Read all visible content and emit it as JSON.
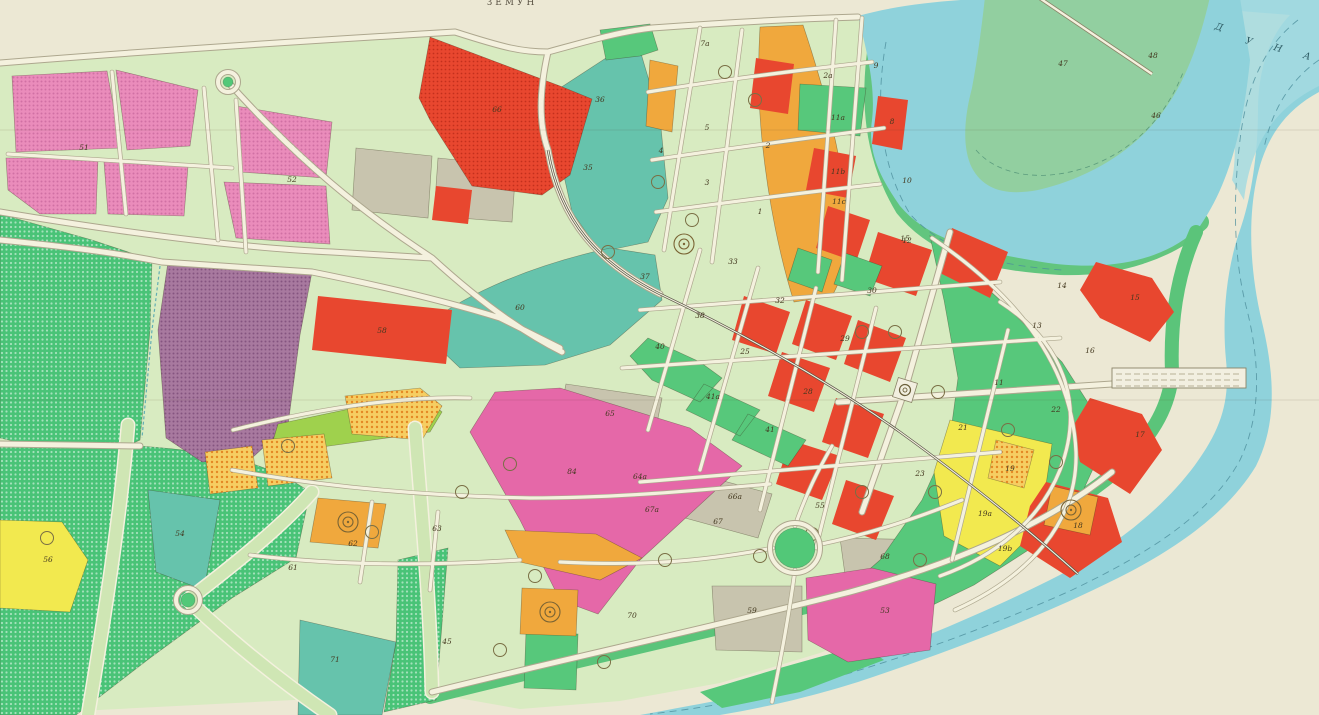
{
  "map": {
    "title": "ЗЕМУН",
    "river_letters": [
      {
        "ch": "Д",
        "x": 1218,
        "y": 30
      },
      {
        "ch": "У",
        "x": 1248,
        "y": 44
      },
      {
        "ch": "Н",
        "x": 1277,
        "y": 51
      },
      {
        "ch": "А",
        "x": 1306,
        "y": 59
      }
    ],
    "labels": [
      {
        "t": "51",
        "x": 84,
        "y": 150
      },
      {
        "t": "52",
        "x": 292,
        "y": 182
      },
      {
        "t": "66",
        "x": 497,
        "y": 112
      },
      {
        "t": "36",
        "x": 600,
        "y": 102
      },
      {
        "t": "35",
        "x": 588,
        "y": 170
      },
      {
        "t": "7a",
        "x": 705,
        "y": 46
      },
      {
        "t": "2a",
        "x": 828,
        "y": 78
      },
      {
        "t": "9",
        "x": 876,
        "y": 68
      },
      {
        "t": "8",
        "x": 892,
        "y": 124
      },
      {
        "t": "5",
        "x": 707,
        "y": 130
      },
      {
        "t": "4",
        "x": 661,
        "y": 153
      },
      {
        "t": "3",
        "x": 707,
        "y": 185
      },
      {
        "t": "2",
        "x": 768,
        "y": 148
      },
      {
        "t": "1",
        "x": 760,
        "y": 214
      },
      {
        "t": "11a",
        "x": 838,
        "y": 120
      },
      {
        "t": "11b",
        "x": 838,
        "y": 174
      },
      {
        "t": "11c",
        "x": 839,
        "y": 204
      },
      {
        "t": "10",
        "x": 907,
        "y": 183
      },
      {
        "t": "12",
        "x": 907,
        "y": 243
      },
      {
        "t": "15",
        "x": 905,
        "y": 241
      },
      {
        "t": "47",
        "x": 1063,
        "y": 66
      },
      {
        "t": "48",
        "x": 1153,
        "y": 58
      },
      {
        "t": "46",
        "x": 1156,
        "y": 118
      },
      {
        "t": "14",
        "x": 1062,
        "y": 288
      },
      {
        "t": "13",
        "x": 1037,
        "y": 328
      },
      {
        "t": "15",
        "x": 1135,
        "y": 300
      },
      {
        "t": "16",
        "x": 1090,
        "y": 353
      },
      {
        "t": "17",
        "x": 1140,
        "y": 437
      },
      {
        "t": "18",
        "x": 1078,
        "y": 528
      },
      {
        "t": "22",
        "x": 1056,
        "y": 412
      },
      {
        "t": "30",
        "x": 872,
        "y": 293
      },
      {
        "t": "29",
        "x": 845,
        "y": 341
      },
      {
        "t": "28",
        "x": 808,
        "y": 394
      },
      {
        "t": "33",
        "x": 733,
        "y": 264
      },
      {
        "t": "37",
        "x": 645,
        "y": 279
      },
      {
        "t": "38",
        "x": 700,
        "y": 318
      },
      {
        "t": "32",
        "x": 780,
        "y": 303
      },
      {
        "t": "25",
        "x": 745,
        "y": 354
      },
      {
        "t": "40",
        "x": 660,
        "y": 349
      },
      {
        "t": "41a",
        "x": 713,
        "y": 399
      },
      {
        "t": "41",
        "x": 770,
        "y": 432
      },
      {
        "t": "65",
        "x": 610,
        "y": 416
      },
      {
        "t": "64a",
        "x": 640,
        "y": 479
      },
      {
        "t": "66a",
        "x": 735,
        "y": 499
      },
      {
        "t": "68",
        "x": 885,
        "y": 559
      },
      {
        "t": "23",
        "x": 920,
        "y": 476
      },
      {
        "t": "21",
        "x": 963,
        "y": 430
      },
      {
        "t": "11",
        "x": 999,
        "y": 385
      },
      {
        "t": "19",
        "x": 1010,
        "y": 471
      },
      {
        "t": "19a",
        "x": 985,
        "y": 516
      },
      {
        "t": "19b",
        "x": 1005,
        "y": 551
      },
      {
        "t": "55",
        "x": 820,
        "y": 508
      },
      {
        "t": "60",
        "x": 520,
        "y": 310
      },
      {
        "t": "84",
        "x": 572,
        "y": 474
      },
      {
        "t": "58",
        "x": 382,
        "y": 333
      },
      {
        "t": "61",
        "x": 293,
        "y": 570
      },
      {
        "t": "62",
        "x": 353,
        "y": 546
      },
      {
        "t": "63",
        "x": 437,
        "y": 531
      },
      {
        "t": "67a",
        "x": 652,
        "y": 512
      },
      {
        "t": "67",
        "x": 718,
        "y": 524
      },
      {
        "t": "70",
        "x": 632,
        "y": 618
      },
      {
        "t": "45",
        "x": 447,
        "y": 644
      },
      {
        "t": "59",
        "x": 752,
        "y": 613
      },
      {
        "t": "53",
        "x": 885,
        "y": 613
      },
      {
        "t": "54",
        "x": 180,
        "y": 536
      },
      {
        "t": "56",
        "x": 48,
        "y": 562
      },
      {
        "t": "71",
        "x": 335,
        "y": 662
      }
    ],
    "symbols": {
      "tree_circles": [
        {
          "x": 755,
          "y": 100
        },
        {
          "x": 725,
          "y": 72
        },
        {
          "x": 658,
          "y": 182
        },
        {
          "x": 692,
          "y": 220
        },
        {
          "x": 608,
          "y": 252
        },
        {
          "x": 510,
          "y": 464
        },
        {
          "x": 462,
          "y": 492
        },
        {
          "x": 288,
          "y": 446
        },
        {
          "x": 47,
          "y": 538
        },
        {
          "x": 372,
          "y": 532
        },
        {
          "x": 862,
          "y": 332
        },
        {
          "x": 895,
          "y": 332
        },
        {
          "x": 938,
          "y": 392
        },
        {
          "x": 1008,
          "y": 430
        },
        {
          "x": 862,
          "y": 492
        },
        {
          "x": 935,
          "y": 492
        },
        {
          "x": 760,
          "y": 556
        },
        {
          "x": 535,
          "y": 576
        },
        {
          "x": 604,
          "y": 662
        },
        {
          "x": 500,
          "y": 650
        },
        {
          "x": 812,
          "y": 534
        },
        {
          "x": 1056,
          "y": 462
        },
        {
          "x": 920,
          "y": 560
        },
        {
          "x": 665,
          "y": 560
        }
      ],
      "plaza_circles": [
        {
          "x": 348,
          "y": 522
        },
        {
          "x": 550,
          "y": 612
        },
        {
          "x": 1071,
          "y": 510
        },
        {
          "x": 684,
          "y": 244
        }
      ],
      "roundabouts": [
        {
          "x": 795,
          "y": 548,
          "r": 20
        },
        {
          "x": 188,
          "y": 600,
          "r": 7
        },
        {
          "x": 228,
          "y": 82,
          "r": 5
        }
      ],
      "monument": {
        "x": 905,
        "y": 390
      }
    },
    "palette": {
      "water": "#8FD2DB",
      "paper_cream": "#ECE8D4",
      "city_green": "#D8EBC1",
      "parcel_yellow": "#F2E94F",
      "parcel_red": "#E8472F",
      "parcel_orange": "#F0A83D",
      "block_pink": "#EA8CBB",
      "wedge_magenta": "#E568A8",
      "parcel_purple": "#A8799F",
      "parcel_teal": "#66C3AC",
      "park_dotted_green": "#49C377",
      "parcel_green": "#57C87B",
      "parcel_lime": "#9FD14D",
      "parcel_grey": "#C8C4AE",
      "road": "#F4F1DE"
    }
  }
}
